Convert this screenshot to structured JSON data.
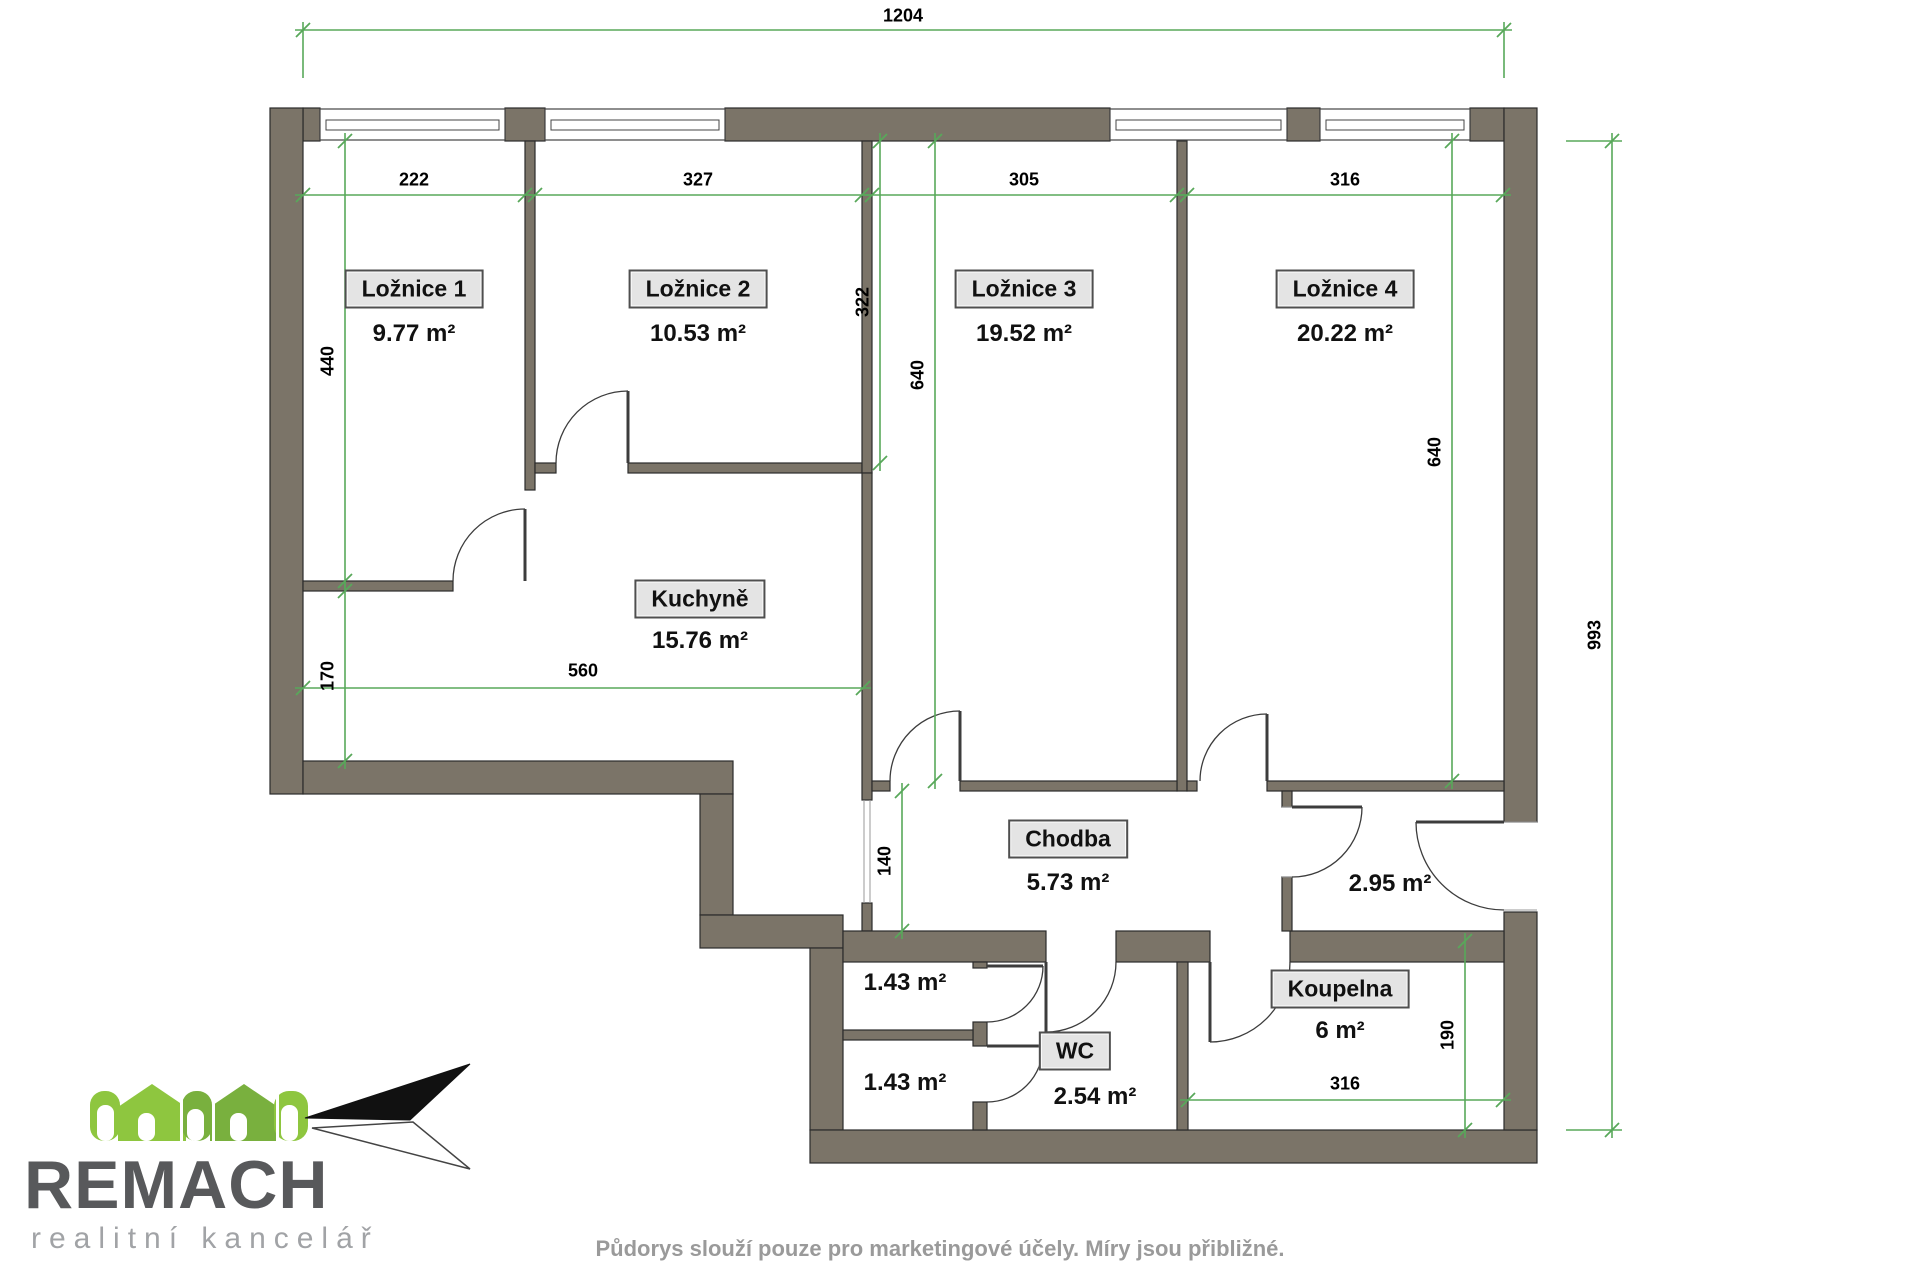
{
  "floor_plan": {
    "colors": {
      "wall_fill": "#7b7468",
      "wall_outline": "#2b2b2b",
      "dim_green": "#58a85a",
      "door_line": "#3c3c3c",
      "frame_gray": "#9a9a9a"
    },
    "rooms": [
      {
        "name": "Ložnice 1",
        "area": "9.77 m²",
        "boxed": true,
        "x": 414,
        "y": 289,
        "ax": 414,
        "ay": 334
      },
      {
        "name": "Ložnice 2",
        "area": "10.53 m²",
        "boxed": true,
        "x": 698,
        "y": 289,
        "ax": 698,
        "ay": 334
      },
      {
        "name": "Ložnice 3",
        "area": "19.52 m²",
        "boxed": true,
        "x": 1024,
        "y": 289,
        "ax": 1024,
        "ay": 334
      },
      {
        "name": "Ložnice 4",
        "area": "20.22 m²",
        "boxed": true,
        "x": 1345,
        "y": 289,
        "ax": 1345,
        "ay": 334
      },
      {
        "name": "Kuchyně",
        "area": "15.76 m²",
        "boxed": true,
        "x": 700,
        "y": 599,
        "ax": 700,
        "ay": 641
      },
      {
        "name": "Chodba",
        "area": "5.73 m²",
        "boxed": true,
        "x": 1068,
        "y": 839,
        "ax": 1068,
        "ay": 883
      },
      {
        "name": "Koupelna",
        "area": "6 m²",
        "boxed": true,
        "x": 1340,
        "y": 989,
        "ax": 1340,
        "ay": 1031
      },
      {
        "name": "WC",
        "area": "2.54 m²",
        "boxed": true,
        "x": 1075,
        "y": 1051,
        "ax": 1095,
        "ay": 1097
      },
      {
        "name": "",
        "area": "2.95 m²",
        "boxed": false,
        "x": 1390,
        "y": 884,
        "ax": 1390,
        "ay": 884
      },
      {
        "name": "",
        "area": "1.43 m²",
        "boxed": false,
        "x": 905,
        "y": 983,
        "ax": 905,
        "ay": 983
      },
      {
        "name": "",
        "area": "1.43 m²",
        "boxed": false,
        "x": 905,
        "y": 1083,
        "ax": 905,
        "ay": 1083
      }
    ],
    "dimensions_cm": [
      {
        "value": "1204",
        "orient": "h",
        "x1": 303,
        "y1": 30,
        "x2": 1504,
        "y2": 30,
        "lx": 903,
        "ly": 16
      },
      {
        "value": "222",
        "orient": "h",
        "x1": 303,
        "y1": 195,
        "x2": 525,
        "y2": 195,
        "lx": 414,
        "ly": 180
      },
      {
        "value": "327",
        "orient": "h",
        "x1": 535,
        "y1": 195,
        "x2": 862,
        "y2": 195,
        "lx": 698,
        "ly": 180
      },
      {
        "value": "305",
        "orient": "h",
        "x1": 872,
        "y1": 195,
        "x2": 1177,
        "y2": 195,
        "lx": 1024,
        "ly": 180
      },
      {
        "value": "316",
        "orient": "h",
        "x1": 1187,
        "y1": 195,
        "x2": 1503,
        "y2": 195,
        "lx": 1345,
        "ly": 180
      },
      {
        "value": "440",
        "orient": "v",
        "x1": 345,
        "y1": 141,
        "x2": 345,
        "y2": 581,
        "lx": 328,
        "ly": 361
      },
      {
        "value": "170",
        "orient": "v",
        "x1": 345,
        "y1": 591,
        "x2": 345,
        "y2": 761,
        "lx": 328,
        "ly": 676
      },
      {
        "value": "322",
        "orient": "v",
        "x1": 880,
        "y1": 141,
        "x2": 880,
        "y2": 463,
        "lx": 863,
        "ly": 302
      },
      {
        "value": "640",
        "orient": "v",
        "x1": 935,
        "y1": 141,
        "x2": 935,
        "y2": 781,
        "lx": 918,
        "ly": 375
      },
      {
        "value": "640",
        "orient": "v",
        "x1": 1452,
        "y1": 141,
        "x2": 1452,
        "y2": 781,
        "lx": 1435,
        "ly": 452
      },
      {
        "value": "560",
        "orient": "h",
        "x1": 303,
        "y1": 688,
        "x2": 863,
        "y2": 688,
        "lx": 583,
        "ly": 671
      },
      {
        "value": "140",
        "orient": "v",
        "x1": 902,
        "y1": 791,
        "x2": 902,
        "y2": 931,
        "lx": 885,
        "ly": 861
      },
      {
        "value": "190",
        "orient": "v",
        "x1": 1465,
        "y1": 941,
        "x2": 1465,
        "y2": 1130,
        "lx": 1448,
        "ly": 1035
      },
      {
        "value": "316",
        "orient": "h",
        "x1": 1188,
        "y1": 1100,
        "x2": 1503,
        "y2": 1100,
        "lx": 1345,
        "ly": 1084
      },
      {
        "value": "993",
        "orient": "v",
        "x1": 1612,
        "y1": 141,
        "x2": 1612,
        "y2": 1130,
        "lx": 1595,
        "ly": 635
      }
    ],
    "extension_lines": [
      [
        303,
        22,
        303,
        78
      ],
      [
        1504,
        22,
        1504,
        78
      ],
      [
        1566,
        141,
        1622,
        141
      ],
      [
        1566,
        1130,
        1622,
        1130
      ]
    ],
    "walls": {
      "exterior": [
        [
          303,
          108,
          17,
          33
        ],
        [
          505,
          108,
          40,
          33
        ],
        [
          725,
          108,
          385,
          33
        ],
        [
          1287,
          108,
          33,
          33
        ],
        [
          1470,
          108,
          34,
          33
        ],
        [
          270,
          108,
          33,
          686
        ],
        [
          303,
          761,
          430,
          33
        ],
        [
          700,
          794,
          33,
          121
        ],
        [
          700,
          915,
          143,
          33
        ],
        [
          810,
          948,
          33,
          182
        ],
        [
          810,
          1130,
          727,
          33
        ],
        [
          1504,
          108,
          33,
          714
        ],
        [
          1504,
          912,
          33,
          218
        ]
      ],
      "interior": [
        [
          525,
          141,
          10,
          349
        ],
        [
          303,
          581,
          150,
          10
        ],
        [
          535,
          463,
          21,
          10
        ],
        [
          628,
          463,
          234,
          10
        ],
        [
          862,
          141,
          10,
          332
        ],
        [
          862,
          473,
          10,
          327
        ],
        [
          862,
          903,
          10,
          28
        ],
        [
          843,
          931,
          203,
          31
        ],
        [
          1116,
          931,
          94,
          31
        ],
        [
          1290,
          931,
          214,
          31
        ],
        [
          1177,
          141,
          10,
          650
        ],
        [
          872,
          781,
          18,
          10
        ],
        [
          960,
          781,
          217,
          10
        ],
        [
          1187,
          781,
          10,
          10
        ],
        [
          1267,
          781,
          237,
          10
        ],
        [
          1282,
          791,
          10,
          16
        ],
        [
          1282,
          877,
          10,
          54
        ],
        [
          973,
          962,
          14,
          6
        ],
        [
          973,
          1022,
          14,
          24
        ],
        [
          973,
          1102,
          14,
          28
        ],
        [
          843,
          1030,
          130,
          10
        ],
        [
          1177,
          962,
          11,
          168
        ]
      ]
    },
    "windows": [
      [
        320,
        185
      ],
      [
        545,
        180
      ],
      [
        1110,
        177
      ],
      [
        1320,
        150
      ]
    ],
    "doors": [
      {
        "arc": "M453,581 A72,72 0 0 1 525,509",
        "leaf": [
          525,
          509,
          525,
          581
        ]
      },
      {
        "arc": "M556,463 A72,72 0 0 1 628,391",
        "leaf": [
          628,
          391,
          628,
          463
        ]
      },
      {
        "arc": "M890,781 A70,70 0 0 1 960,711",
        "leaf": [
          960,
          711,
          960,
          781
        ]
      },
      {
        "arc": "M1200,781 A67,67 0 0 1 1267,714",
        "leaf": [
          1267,
          714,
          1267,
          781
        ]
      },
      {
        "arc": "M1362,807 A70,70 0 0 1 1292,877",
        "leaf": [
          1292,
          807,
          1362,
          807
        ]
      },
      {
        "arc": "M1416,822 A88,88 0 0 0 1504,910",
        "leaf": [
          1416,
          822,
          1504,
          822
        ]
      },
      {
        "arc": "M1046,1032 A70,70 0 0 0 1116,962",
        "leaf": [
          1046,
          962,
          1046,
          1032
        ]
      },
      {
        "arc": "M1210,1042 A80,80 0 0 0 1290,962",
        "leaf": [
          1210,
          962,
          1210,
          1042
        ]
      },
      {
        "arc": "M1043,966 A56,56 0 0 1 987,1022",
        "leaf": [
          987,
          966,
          1043,
          966
        ]
      },
      {
        "arc": "M1043,1046 A56,56 0 0 1 987,1102",
        "leaf": [
          987,
          1046,
          1043,
          1046
        ]
      }
    ],
    "frame_lines": [
      [
        864,
        800,
        864,
        903
      ],
      [
        870,
        800,
        870,
        903
      ],
      [
        1504,
        822,
        1537,
        822
      ],
      [
        1504,
        910,
        1537,
        910
      ],
      [
        1282,
        807,
        1292,
        807
      ],
      [
        1282,
        877,
        1292,
        877
      ]
    ]
  },
  "logo": {
    "brand": "REMACH",
    "subtitle": "realitní kancelář",
    "green_light": "#8ec63f",
    "green_dark": "#79b03e",
    "text_color": "#58595b",
    "subtitle_color": "#a1a3a6"
  },
  "footer": {
    "disclaimer": "Půdorys slouží pouze pro marketingové účely. Míry jsou přibližné."
  }
}
